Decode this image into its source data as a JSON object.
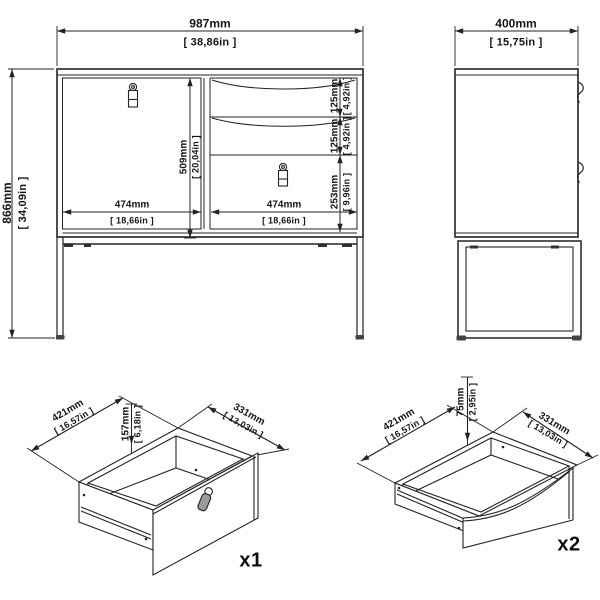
{
  "front_view": {
    "width_mm": "987mm",
    "width_in": "[ 38,86in ]",
    "height_mm": "866mm",
    "height_in": "[ 34,09in ]",
    "door_height_mm": "509mm",
    "door_height_in": "[ 20,04in ]",
    "door_width_mm": "474mm",
    "door_width_in": "[ 18,66in ]",
    "right_width_mm": "474mm",
    "right_width_in": "[ 18,66in ]",
    "drawer1_mm": "125mm",
    "drawer1_in": "[ 4,92in ]",
    "drawer2_mm": "125mm",
    "drawer2_in": "[ 4,92in ]",
    "drawer3_mm": "253mm",
    "drawer3_in": "[ 9,96in ]"
  },
  "side_view": {
    "depth_mm": "400mm",
    "depth_in": "[ 15,75in ]"
  },
  "drawer_x1": {
    "depth_mm": "421mm",
    "depth_in": "[ 16,57in ]",
    "height_mm": "157mm",
    "height_in": "[ 6,18in ]",
    "width_mm": "331mm",
    "width_in": "[ 13,03in ]",
    "count": "x1"
  },
  "drawer_x2": {
    "height_mm": "75mm",
    "height_in": "[ 2,95in ]",
    "depth_mm": "421mm",
    "depth_in": "[ 16,57in ]",
    "width_mm": "331mm",
    "width_in": "[ 13,03in ]",
    "count": "x2"
  },
  "colors": {
    "line": "#222222",
    "text": "#111111",
    "background": "#ffffff"
  }
}
